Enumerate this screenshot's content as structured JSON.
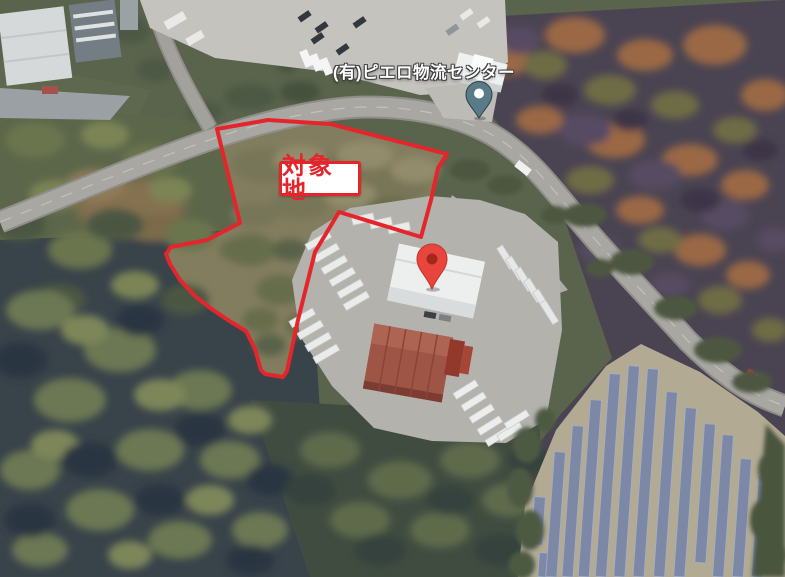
{
  "map": {
    "place_label": "(有)ピエロ物流センター",
    "area_label": "対象地",
    "colors": {
      "annotation_red": "#e4262c",
      "place_pin_teal": "#587b87",
      "place_pin_dot": "#ffffff",
      "marker_red": "#e8453c",
      "marker_red_inner": "#a3271b"
    },
    "icons": {
      "place_pin": "place-pin-icon",
      "location_marker": "location-marker-icon"
    }
  }
}
